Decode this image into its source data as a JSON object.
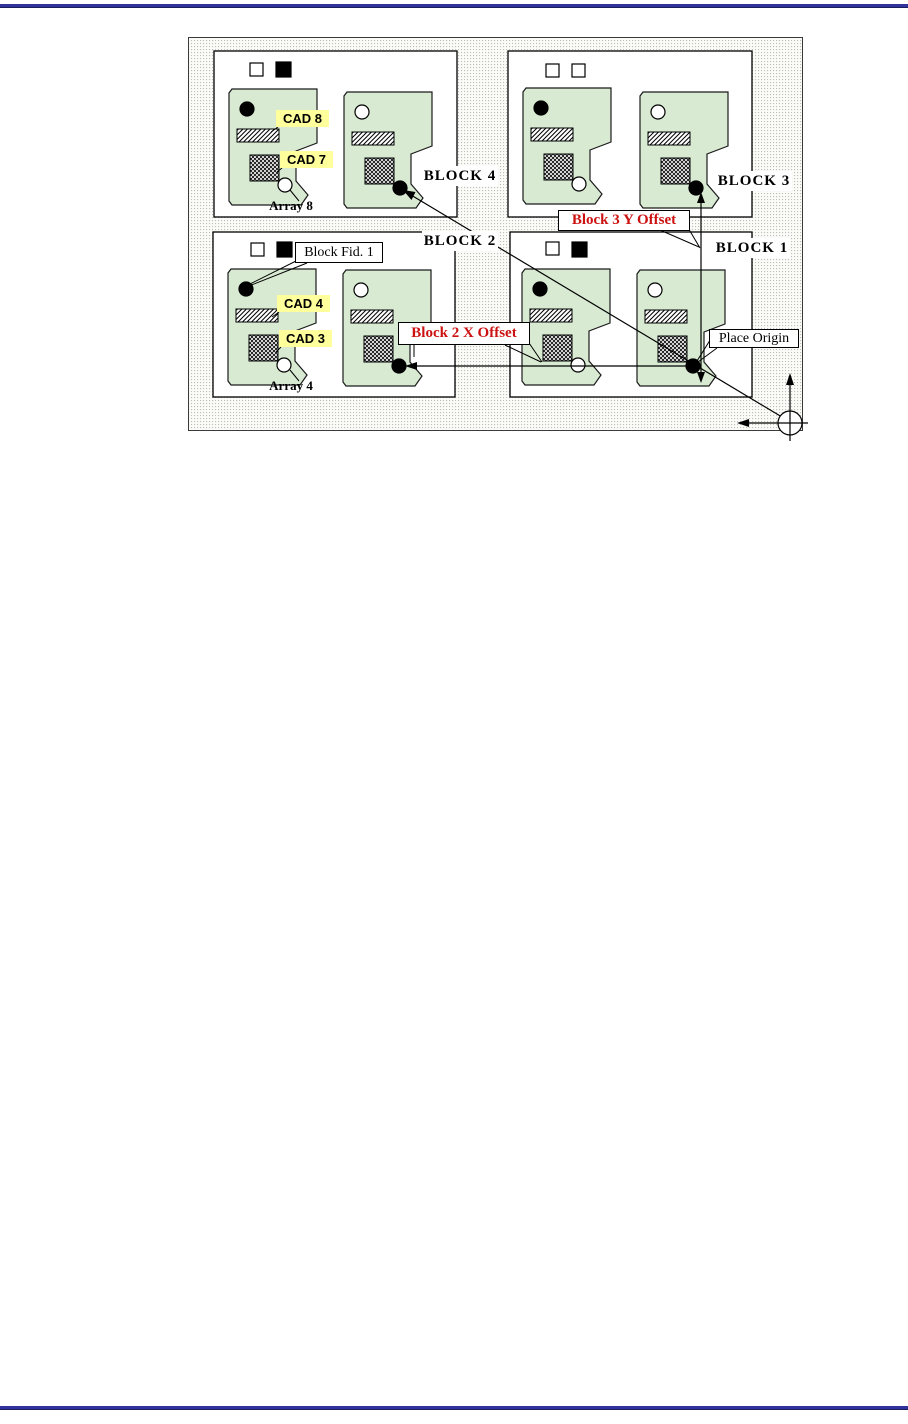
{
  "panel": {
    "blocks": [
      {
        "id": "block4",
        "label": "BLOCK 4"
      },
      {
        "id": "block3",
        "label": "BLOCK 3"
      },
      {
        "id": "block2",
        "label": "BLOCK 2"
      },
      {
        "id": "block1",
        "label": "BLOCK 1"
      }
    ],
    "cad_labels": {
      "cad8": "CAD 8",
      "cad7": "CAD 7",
      "cad4": "CAD 4",
      "cad3": "CAD 3"
    },
    "array_labels": {
      "array8": "Array 8",
      "array4": "Array 4"
    },
    "callouts": {
      "block_fid": "Block Fid. 1",
      "place_origin": "Place Origin",
      "block3_y_offset": "Block 3 Y Offset",
      "block2_x_offset": "Block 2 X Offset"
    },
    "colors": {
      "array_fill": "#d9ead3",
      "cad_highlight": "#ffff9c",
      "offset_text": "#cc1111",
      "page_rule": "#31329b"
    }
  }
}
